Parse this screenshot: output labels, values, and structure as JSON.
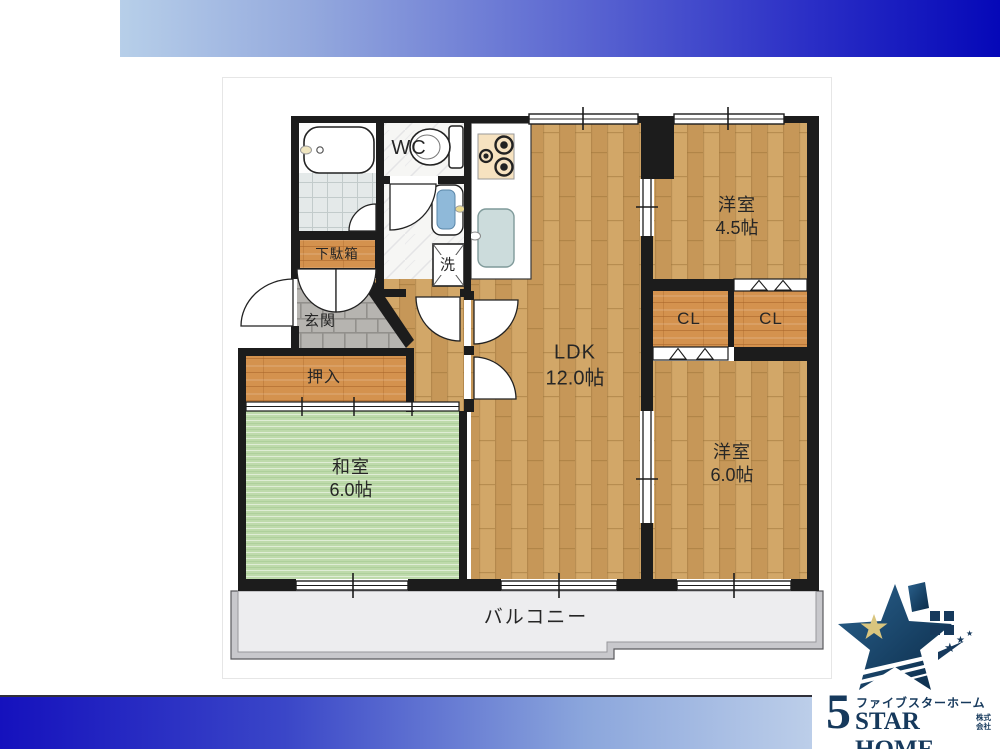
{
  "plan": {
    "rooms": {
      "ldk": {
        "name": "LDK",
        "size": "12.0帖"
      },
      "western_room_small": {
        "name": "洋室",
        "size": "4.5帖"
      },
      "western_room_large": {
        "name": "洋室",
        "size": "6.0帖"
      },
      "japanese_room": {
        "name": "和室",
        "size": "6.0帖"
      },
      "balcony": {
        "name": "バルコニー"
      },
      "entrance": {
        "name": "玄関"
      },
      "wc": {
        "name": "WC"
      },
      "closet_left": {
        "name": "CL"
      },
      "closet_right": {
        "name": "CL"
      },
      "oshiire": {
        "name": "押入"
      },
      "shoe_cabinet": {
        "name": "下駄箱"
      },
      "laundry": {
        "name": "洗"
      }
    },
    "colors": {
      "wall": "#1c1c1c",
      "wood_floor": "#cda063",
      "closet_wood": "#d4924e",
      "tatami": "#bedaab",
      "entrance_stone": "#b6b4b0",
      "bath_tile": "#e4e9e9",
      "balcony": "#ededef",
      "banner_light": "#b7cfe9",
      "banner_dark": "#0508b8",
      "logo_navy": "#16395c",
      "logo_gold": "#d9c57e"
    }
  },
  "logo": {
    "five": "5",
    "kana": "ファイブスターホーム",
    "latin": "STAR HOME",
    "corp_top": "株式",
    "corp_bottom": "会社"
  }
}
